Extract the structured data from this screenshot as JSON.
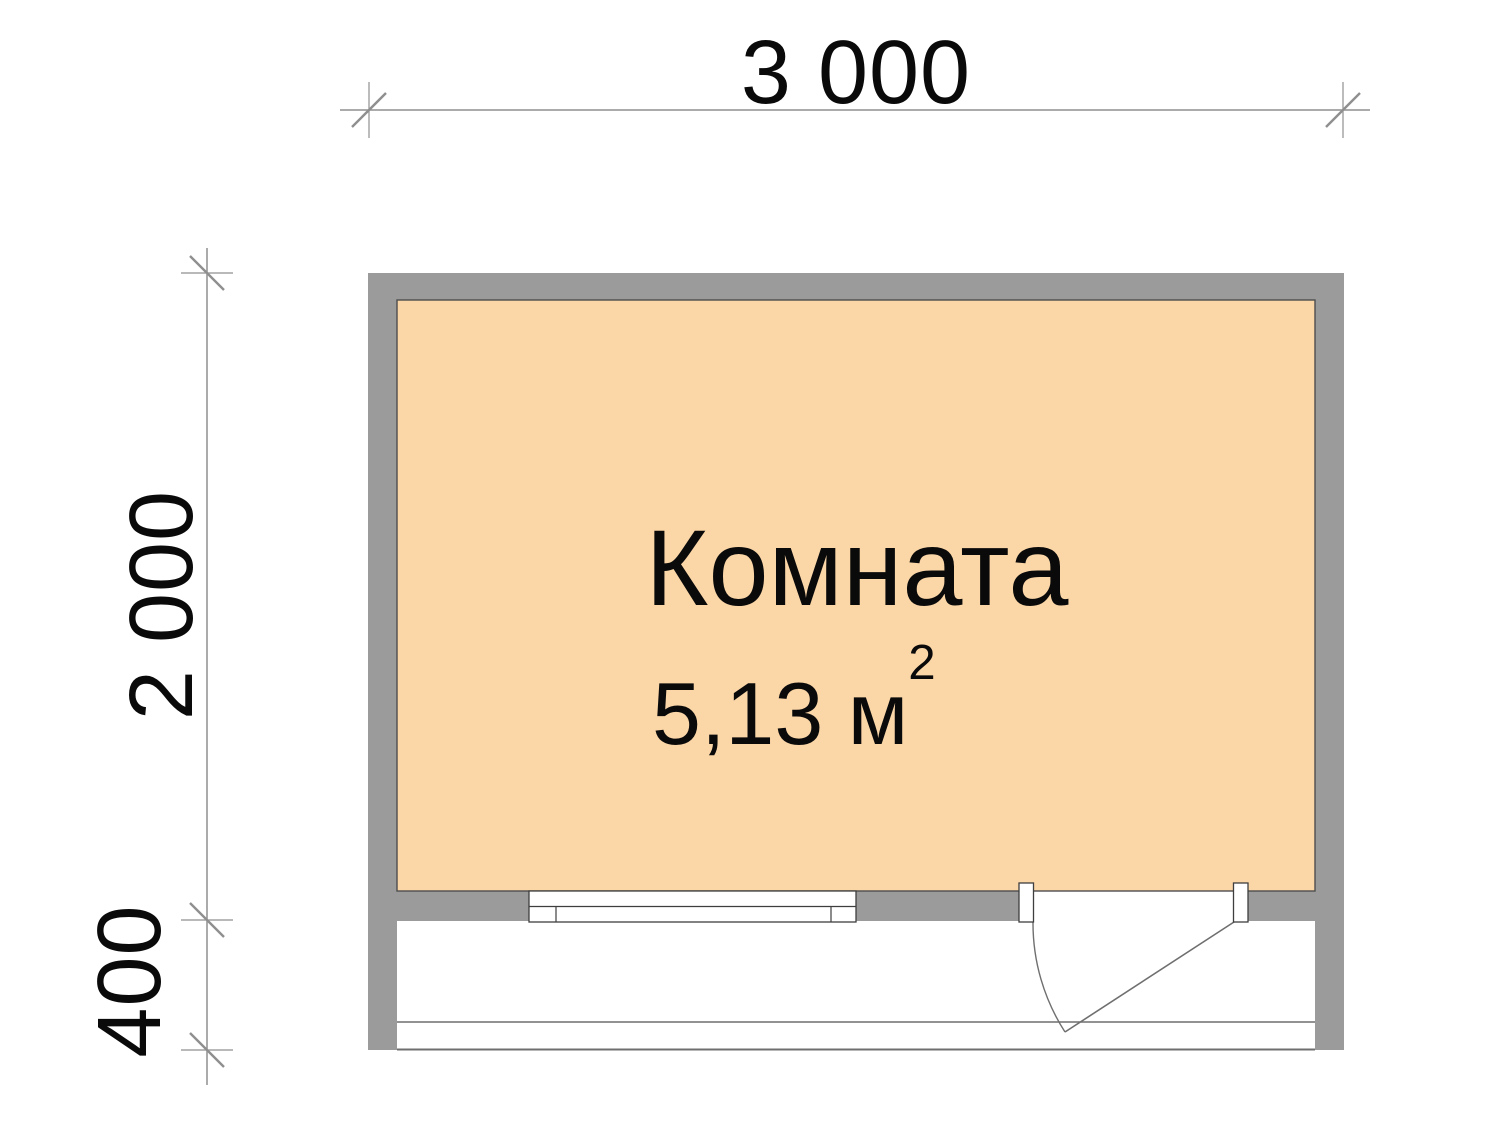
{
  "labels": {
    "width": "3 000",
    "height": "2 000",
    "porch_depth": "400"
  },
  "room": {
    "name": "Комната",
    "area": "5,13 м",
    "area_exponent": "2"
  },
  "colors": {
    "room_fill": "#FBD6A7",
    "wall": "#9B9B9B",
    "wall_edge": "#4E4E4E",
    "thin_line": "#6F6F6F",
    "dimension_line": "#8F8F8F",
    "text": "#0A0A0A"
  }
}
